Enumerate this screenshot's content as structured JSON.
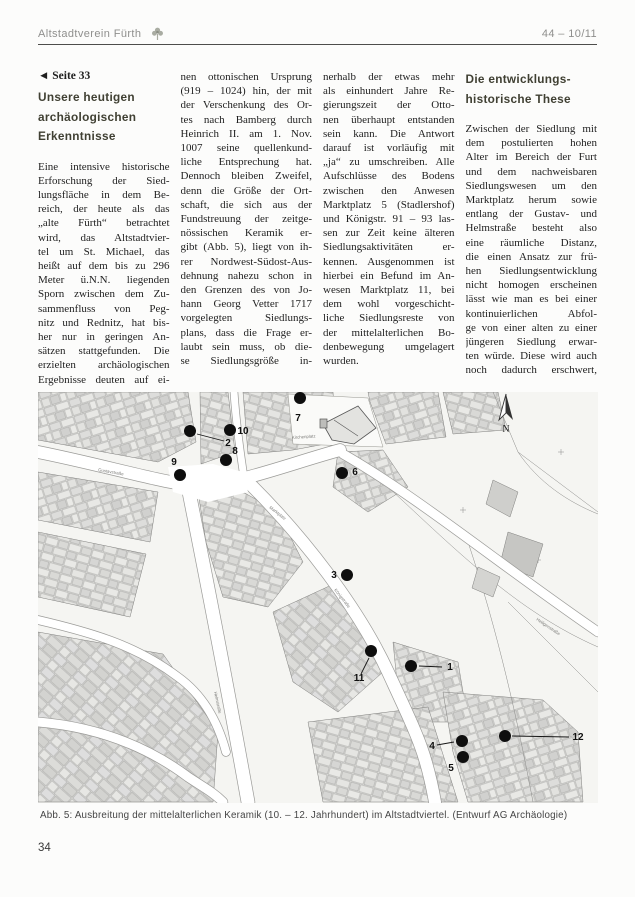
{
  "header": {
    "journal": "Altstadtverein Fürth",
    "issue": "44 – 10/11"
  },
  "icons": {
    "logo": "kleeblatt-logo",
    "map_compass": "north-arrow"
  },
  "article": {
    "backref": "◄ Seite 33",
    "col1": {
      "heading": {
        "lines": [
          "Unsere heutigen",
          "archäologischen",
          "Erkenntnisse"
        ]
      },
      "body": {
        "flush": false,
        "lines": [
          "Eine intensive historische",
          "Erforschung der Sied-",
          "lungsfläche in dem Be-",
          "reich, der heute als das",
          "„alte Fürth“ betrachtet",
          "wird, das Altstadtvier-",
          "tel um St. Michael, das",
          "heißt auf dem bis zu 296",
          "Meter ü.N.N. liegenden",
          "Sporn zwischen dem Zu-",
          "sammenfluss von Peg-",
          "nitz und Rednitz, hat bis-",
          "her nur in geringen An-",
          "sätzen stattgefunden. Die",
          "erzielten archäologischen",
          "Ergebnisse deuten auf ei-"
        ]
      }
    },
    "col2": {
      "body": {
        "flush": false,
        "lines": [
          "nen ottonischen Ursprung",
          "(919 – 1024) hin, der mit",
          "der Verschenkung des Or-",
          "tes nach Bamberg durch",
          "Heinrich II. am 1. Nov.",
          "1007 seine quellenkund-",
          "liche Entsprechung hat.",
          "Dennoch bleiben Zweifel,",
          "denn die Größe der Ort-",
          "schaft, die sich aus der",
          "Fundstreuung der zeitge-",
          "nössischen Keramik er-",
          "gibt (Abb. 5), liegt von ih-",
          "rer Nordwest-Südost-Aus-",
          "dehnung nahezu schon in",
          "den Grenzen des von Jo-",
          "hann Georg Vetter 1717",
          "vorgelegten Siedlungs-",
          "plans, dass die Frage er-",
          "laubt sein muss, ob die-",
          "se Siedlungsgröße in-"
        ]
      }
    },
    "col3": {
      "body": {
        "flush": true,
        "lines": [
          "nerhalb der etwas mehr",
          "als einhundert Jahre Re-",
          "gierungszeit der Otto-",
          "nen überhaupt entstanden",
          "sein kann. Die Antwort",
          "darauf ist vorläufig mit",
          "„ja“ zu umschreiben. Alle",
          "Aufschlüsse des Bodens",
          "zwischen den Anwesen",
          "Marktplatz 5 (Stadlershof)",
          "und Königstr. 91 – 93 las-",
          "sen zur Zeit keine älteren",
          "Siedlungsaktivitäten er-",
          "kennen. Ausgenommen ist",
          "hierbei ein Befund im An-",
          "wesen Marktplatz 11, bei",
          "dem wohl vorgeschicht-",
          "liche Siedlungsreste von",
          "der mittelalterlichen Bo-",
          "denbewegung umgelagert",
          "wurden."
        ]
      }
    },
    "col4": {
      "heading": {
        "lines": [
          "Die entwicklungs-",
          "historische These"
        ]
      },
      "body": {
        "flush": false,
        "lines": [
          "Zwischen der Siedlung mit",
          "dem postulierten hohen",
          "Alter im Bereich der Furt",
          "und dem nachweisbaren",
          "Siedlungswesen um den",
          "Marktplatz herum sowie",
          "entlang der Gustav- und",
          "Helmstraße besteht also",
          "eine räumliche Distanz,",
          "die einen Ansatz zur frü-",
          "hen Siedlungsentwicklung",
          "nicht homogen erscheinen",
          "lässt wie man es bei einer",
          "kontinuierlichen    Abfol-",
          "ge von einer alten zu einer",
          "jüngeren Siedlung erwar-",
          "ten würde. Diese wird auch",
          "noch dadurch erschwert,"
        ]
      }
    }
  },
  "figure": {
    "caption": "Abb. 5: Ausbreitung der mittelalterlichen Keramik (10. – 12. Jahrhundert) im Altstadtviertel. (Entwurf AG Archäologie)",
    "compass": "N",
    "markers": [
      {
        "n": "1",
        "dot": [
          373,
          274
        ],
        "label": [
          412,
          278
        ],
        "leader": [
          [
            404,
            275
          ],
          [
            381,
            274
          ]
        ]
      },
      {
        "n": "2",
        "dot": [
          152,
          39
        ],
        "label": [
          190,
          54
        ],
        "leader": [
          [
            186,
            49
          ],
          [
            159,
            42
          ]
        ]
      },
      {
        "n": "3",
        "dot": [
          309,
          183
        ],
        "label": [
          296,
          186
        ]
      },
      {
        "n": "4",
        "dot": [
          424,
          349
        ],
        "label": [
          394,
          357
        ],
        "leader": [
          [
            399,
            353
          ],
          [
            416,
            350
          ]
        ]
      },
      {
        "n": "5",
        "dot": [
          425,
          365
        ],
        "label": [
          413,
          379
        ]
      },
      {
        "n": "6",
        "dot": [
          304,
          81
        ],
        "label": [
          317,
          83
        ]
      },
      {
        "n": "7",
        "dot": [
          262,
          6
        ],
        "label": [
          260,
          29
        ]
      },
      {
        "n": "8",
        "dot": [
          188,
          68
        ],
        "label": [
          197,
          62
        ]
      },
      {
        "n": "9",
        "dot": [
          142,
          83
        ],
        "label": [
          136,
          73
        ]
      },
      {
        "n": "10",
        "dot": [
          192,
          38
        ],
        "label": [
          205,
          42
        ]
      },
      {
        "n": "11",
        "dot": [
          333,
          259
        ],
        "label": [
          321,
          289
        ],
        "leader": [
          [
            323,
            282
          ],
          [
            331,
            266
          ]
        ]
      },
      {
        "n": "12",
        "dot": [
          467,
          344
        ],
        "label": [
          540,
          348
        ],
        "leader": [
          [
            531,
            345
          ],
          [
            474,
            344
          ]
        ]
      }
    ],
    "street_labels": [
      {
        "text": "Gustavstraße",
        "x": 60,
        "y": 79,
        "rot": 10
      },
      {
        "text": "Marktplatz",
        "x": 231,
        "y": 116,
        "rot": 38
      },
      {
        "text": "Königstraße",
        "x": 296,
        "y": 198,
        "rot": 52
      },
      {
        "text": "Helmstraße",
        "x": 176,
        "y": 300,
        "rot": 78
      },
      {
        "text": "Kirchenplatz",
        "x": 254,
        "y": 47,
        "rot": -4
      },
      {
        "text": "Heiligenstraße",
        "x": 498,
        "y": 228,
        "rot": 34
      }
    ]
  },
  "footer": {
    "page_number": "34"
  }
}
